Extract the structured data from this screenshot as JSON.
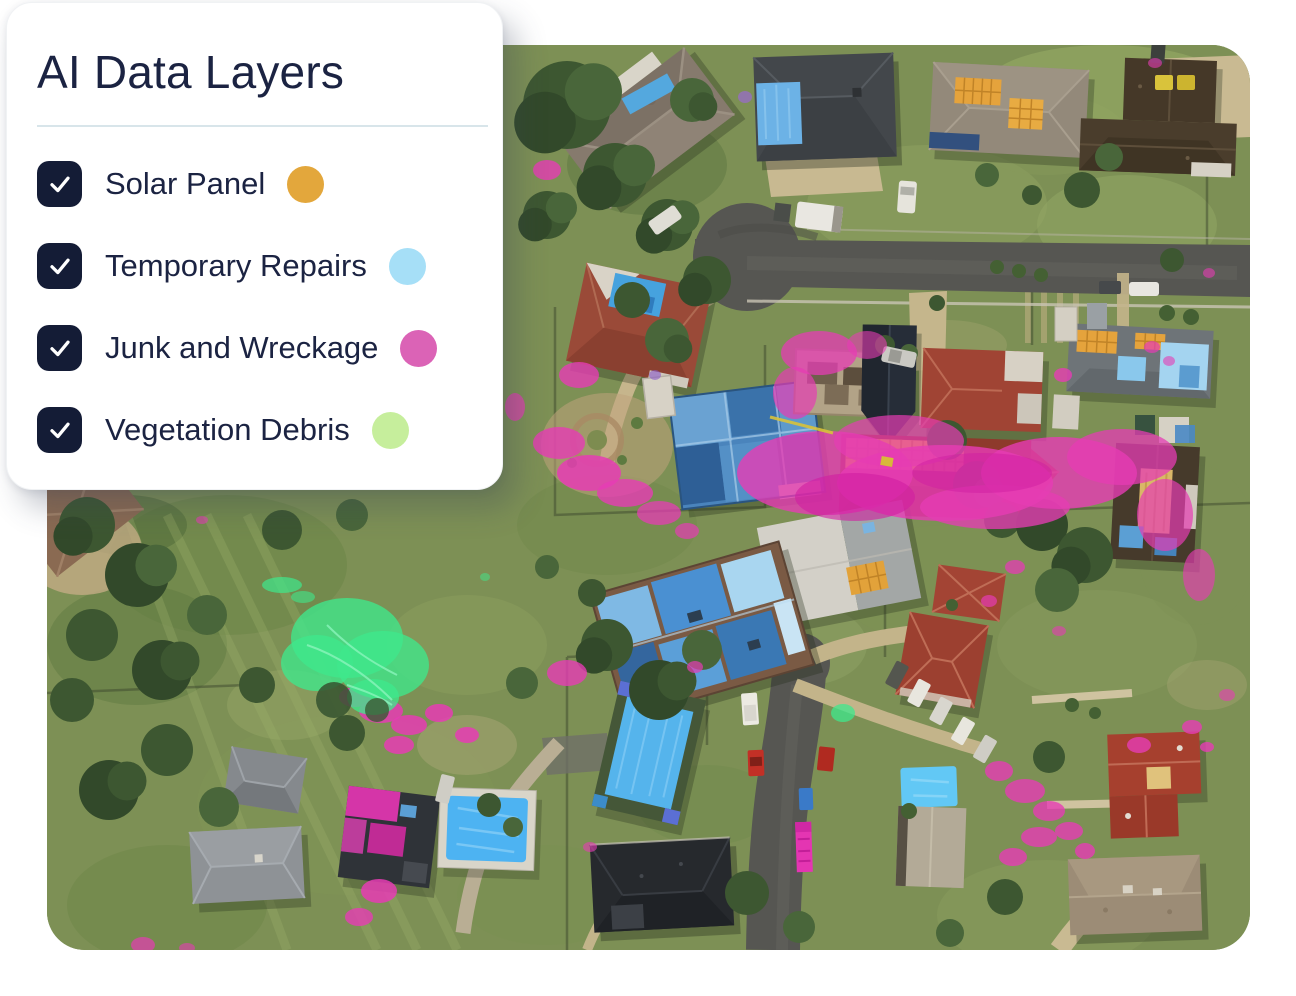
{
  "legend": {
    "title": "AI Data Layers",
    "items": [
      {
        "id": "solar-panel",
        "label": "Solar Panel",
        "color": "#E3A73C",
        "checked": true
      },
      {
        "id": "temporary-repairs",
        "label": "Temporary Repairs",
        "color": "#A6DFF7",
        "checked": true
      },
      {
        "id": "junk-wreckage",
        "label": "Junk and Wreckage",
        "color": "#DB63B6",
        "checked": true
      },
      {
        "id": "vegetation-debris",
        "label": "Vegetation Debris",
        "color": "#C6EE9C",
        "checked": true
      }
    ]
  },
  "map": {
    "type": "aerial-imagery",
    "description": "Post-storm aerial photo of a residential neighbourhood with AI overlay highlights",
    "overlay_colors": {
      "solar_panel": "#E8A33D",
      "temporary_repairs": "#55B6F2",
      "junk_and_wreckage": "#E435B2",
      "vegetation_debris": "#45E98E"
    }
  }
}
